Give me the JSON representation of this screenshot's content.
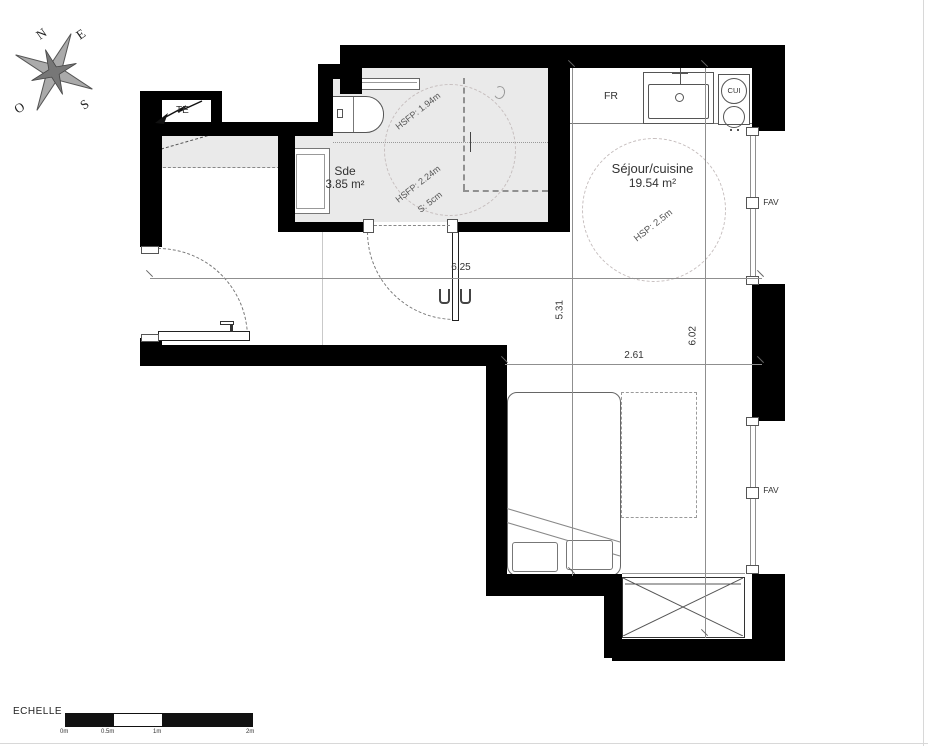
{
  "page": {
    "type": "architectural floor plan"
  },
  "compass": {
    "n": "N",
    "e": "E",
    "s": "S",
    "o": "O"
  },
  "rooms": {
    "sde": {
      "name": "Sde",
      "area": "3.85 m²"
    },
    "sejour": {
      "name": "Séjour/cuisine",
      "area": "19.54 m²"
    }
  },
  "ceiling": {
    "hsfp_low": "HSFP: 1.94m",
    "hsfp_high": "HSFP: 2.24m",
    "soffit": "S: 5cm",
    "hsp": "HSP: 2.5m"
  },
  "equipment": {
    "fridge": "FR",
    "cooktop": "CUI",
    "electrical_panel": "TE",
    "window_top": "FAV",
    "window_bottom": "FAV"
  },
  "dimensions": {
    "overall_width": "6.25",
    "living_height": "5.31",
    "living_width": "2.61",
    "overall_height": "6.02"
  },
  "scale_bar": {
    "label": "ECHELLE",
    "ticks": [
      "0m",
      "0.5m",
      "1m",
      "2m"
    ]
  },
  "colors": {
    "wall": "#000000",
    "shaded_zone": "#eaeaea",
    "dim_line": "#8f8f8f",
    "text": "#333333"
  }
}
